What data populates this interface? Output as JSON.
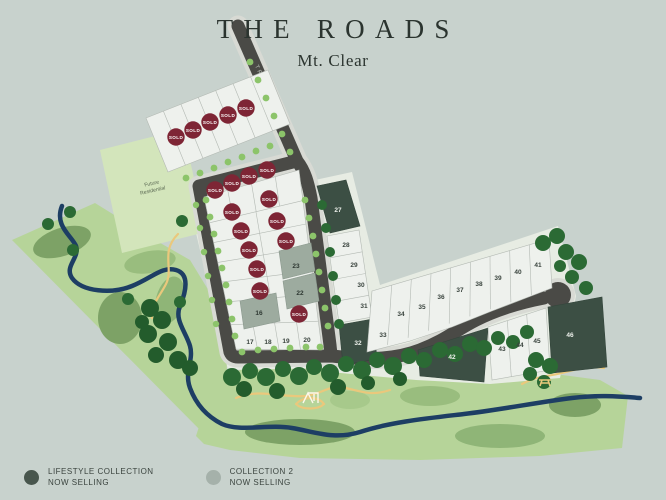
{
  "title": "THE ROADS",
  "subtitle": "Mt. Clear",
  "road_label": "TREZISE LANE",
  "future_area": {
    "lines": [
      "Future",
      "Residential"
    ]
  },
  "sold_label": "SOLD",
  "legend": {
    "items": [
      {
        "line1": "LIFESTYLE COLLECTION",
        "line2": "NOW SELLING",
        "color": "#48564d"
      },
      {
        "line1": "COLLECTION 2",
        "line2": "NOW SELLING",
        "color": "#a5b1aa"
      }
    ]
  },
  "colors": {
    "background": "#c8d2cd",
    "road": "#4a4a46",
    "road_edge": "#d8dad4",
    "sold_badge": "#7e2535",
    "lot_available": "#eef1ed",
    "lot_collection2": "#9dab9f",
    "lot_lifestyle": "#3c4f44",
    "park": "#b6d499",
    "creek": "#1d3e64",
    "path": "#eac87c",
    "tree": "#2b6a34"
  },
  "map": {
    "lots": [
      {
        "number": "16",
        "x": 259,
        "y": 313,
        "collection": "collection2"
      },
      {
        "number": "17",
        "x": 250,
        "y": 342,
        "collection": "standard"
      },
      {
        "number": "18",
        "x": 268,
        "y": 342,
        "collection": "standard"
      },
      {
        "number": "19",
        "x": 286,
        "y": 341,
        "collection": "standard"
      },
      {
        "number": "20",
        "x": 307,
        "y": 340,
        "collection": "standard"
      },
      {
        "number": "22",
        "x": 300,
        "y": 293,
        "collection": "collection2"
      },
      {
        "number": "23",
        "x": 296,
        "y": 266,
        "collection": "collection2"
      },
      {
        "number": "27",
        "x": 338,
        "y": 210,
        "collection": "lifestyle"
      },
      {
        "number": "28",
        "x": 346,
        "y": 245,
        "collection": "standard"
      },
      {
        "number": "29",
        "x": 354,
        "y": 265,
        "collection": "standard"
      },
      {
        "number": "30",
        "x": 361,
        "y": 285,
        "collection": "standard"
      },
      {
        "number": "31",
        "x": 364,
        "y": 306,
        "collection": "standard"
      },
      {
        "number": "32",
        "x": 358,
        "y": 343,
        "collection": "lifestyle"
      },
      {
        "number": "33",
        "x": 383,
        "y": 335,
        "collection": "standard"
      },
      {
        "number": "34",
        "x": 401,
        "y": 314,
        "collection": "standard"
      },
      {
        "number": "35",
        "x": 422,
        "y": 307,
        "collection": "standard"
      },
      {
        "number": "36",
        "x": 441,
        "y": 297,
        "collection": "standard"
      },
      {
        "number": "37",
        "x": 460,
        "y": 290,
        "collection": "standard"
      },
      {
        "number": "38",
        "x": 479,
        "y": 284,
        "collection": "standard"
      },
      {
        "number": "39",
        "x": 498,
        "y": 278,
        "collection": "standard"
      },
      {
        "number": "40",
        "x": 518,
        "y": 272,
        "collection": "standard"
      },
      {
        "number": "41",
        "x": 538,
        "y": 265,
        "collection": "standard"
      },
      {
        "number": "42",
        "x": 452,
        "y": 357,
        "collection": "lifestyle"
      },
      {
        "number": "43",
        "x": 502,
        "y": 349,
        "collection": "standard"
      },
      {
        "number": "44",
        "x": 520,
        "y": 345,
        "collection": "standard"
      },
      {
        "number": "45",
        "x": 537,
        "y": 341,
        "collection": "standard"
      },
      {
        "number": "46",
        "x": 570,
        "y": 335,
        "collection": "lifestyle"
      }
    ],
    "sold_badges": [
      {
        "x": 176,
        "y": 137
      },
      {
        "x": 193,
        "y": 130
      },
      {
        "x": 210,
        "y": 122
      },
      {
        "x": 228,
        "y": 115
      },
      {
        "x": 246,
        "y": 108
      },
      {
        "x": 215,
        "y": 190
      },
      {
        "x": 232,
        "y": 183
      },
      {
        "x": 249,
        "y": 176
      },
      {
        "x": 267,
        "y": 170
      },
      {
        "x": 232,
        "y": 212
      },
      {
        "x": 269,
        "y": 199
      },
      {
        "x": 241,
        "y": 231
      },
      {
        "x": 277,
        "y": 221
      },
      {
        "x": 249,
        "y": 250
      },
      {
        "x": 286,
        "y": 241
      },
      {
        "x": 257,
        "y": 269
      },
      {
        "x": 260,
        "y": 291
      },
      {
        "x": 299,
        "y": 314
      }
    ]
  }
}
